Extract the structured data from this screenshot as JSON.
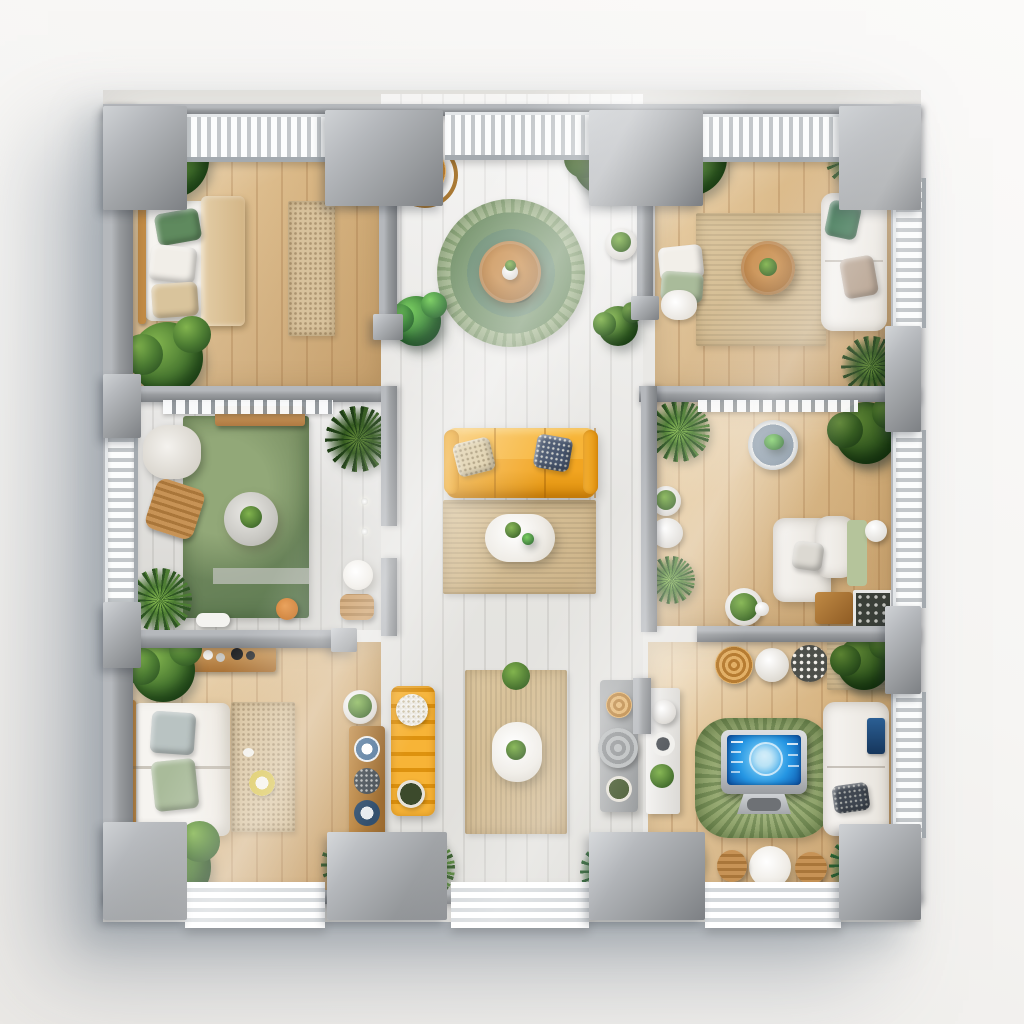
{
  "scene": {
    "type": "top-down-3d-apartment-floor-plan-render",
    "rooms": [
      {
        "id": "bedroom-top-left",
        "furniture": [
          "double-bed",
          "shag-rug",
          "potted-plant",
          "palm-plant",
          "bush-plant"
        ]
      },
      {
        "id": "entry-balcony-top-middle",
        "furniture": [
          "round-green-rug",
          "round-wood-table",
          "rattan-chair",
          "potted-plants"
        ]
      },
      {
        "id": "living-top-right",
        "furniture": [
          "white-sofa",
          "woven-rug",
          "round-wood-coffee-table",
          "floor-cushions",
          "plush-toy",
          "plants"
        ]
      },
      {
        "id": "den-middle-left",
        "furniture": [
          "green-area-rug",
          "round-side-table",
          "wood-chair",
          "white-armchair",
          "wood-bench",
          "pergola-slats",
          "plants"
        ]
      },
      {
        "id": "central-lounge",
        "furniture": [
          "yellow-sofa",
          "patterned-pillows",
          "woven-rug",
          "white-oval-coffee-table"
        ]
      },
      {
        "id": "lounge-middle-right",
        "furniture": [
          "white-armchair",
          "round-basin-table",
          "ball-lamp",
          "wood-side-table",
          "framed-art",
          "moss-bowl",
          "plants"
        ]
      },
      {
        "id": "bedroom-bottom-left",
        "furniture": [
          "single-bed",
          "shag-rug",
          "wood-shelf",
          "plate-rack",
          "plants"
        ]
      },
      {
        "id": "dining-nook-bottom-middle",
        "furniture": [
          "yellow-bench",
          "woven-rug",
          "white-oval-table",
          "gray-console",
          "plants"
        ]
      },
      {
        "id": "smart-home-office-bottom-right",
        "furniture": [
          "desktop-monitor",
          "green-spiky-rug",
          "white-sofa",
          "poufs",
          "round-table-with-chairs",
          "wall-shelf",
          "plants"
        ]
      }
    ],
    "monitor": {
      "display": "smart-home-dashboard",
      "graphic": "globe-circle-widgets",
      "screen_color": "#2596e3"
    }
  },
  "colors": {
    "bg": "#f6f5f3",
    "wall": "#989b9e",
    "wallLight": "#b5b8bc",
    "wallDark": "#7d8084",
    "railSlat": "#c3c7ca",
    "woodLight": "#e6cba1",
    "woodMid": "#d3ae79",
    "whitewash": "#e9e8e5",
    "greenRug": "#85996b",
    "greenRugDark": "#5e7a52",
    "roundRugIn": "#6f9077",
    "beigeRug": "#ccb287",
    "beigeRugLight": "#ddc8a1",
    "sofaYellow": "#f2a521",
    "tableWood": "#b07a42",
    "rattan": "#cf9a4d",
    "plantDark": "#2e5523",
    "plantMid": "#4d7d33",
    "plantLight": "#82b44e",
    "screenBlue": "#2596e3",
    "screenDeep": "#0f5cb0",
    "monitorFrame": "#c2c5c9",
    "brRug": "#95a871",
    "pillowSlate": "#45536b",
    "pillowSage": "#a9bb9a",
    "pillowGreen": "#5f8a5e"
  }
}
